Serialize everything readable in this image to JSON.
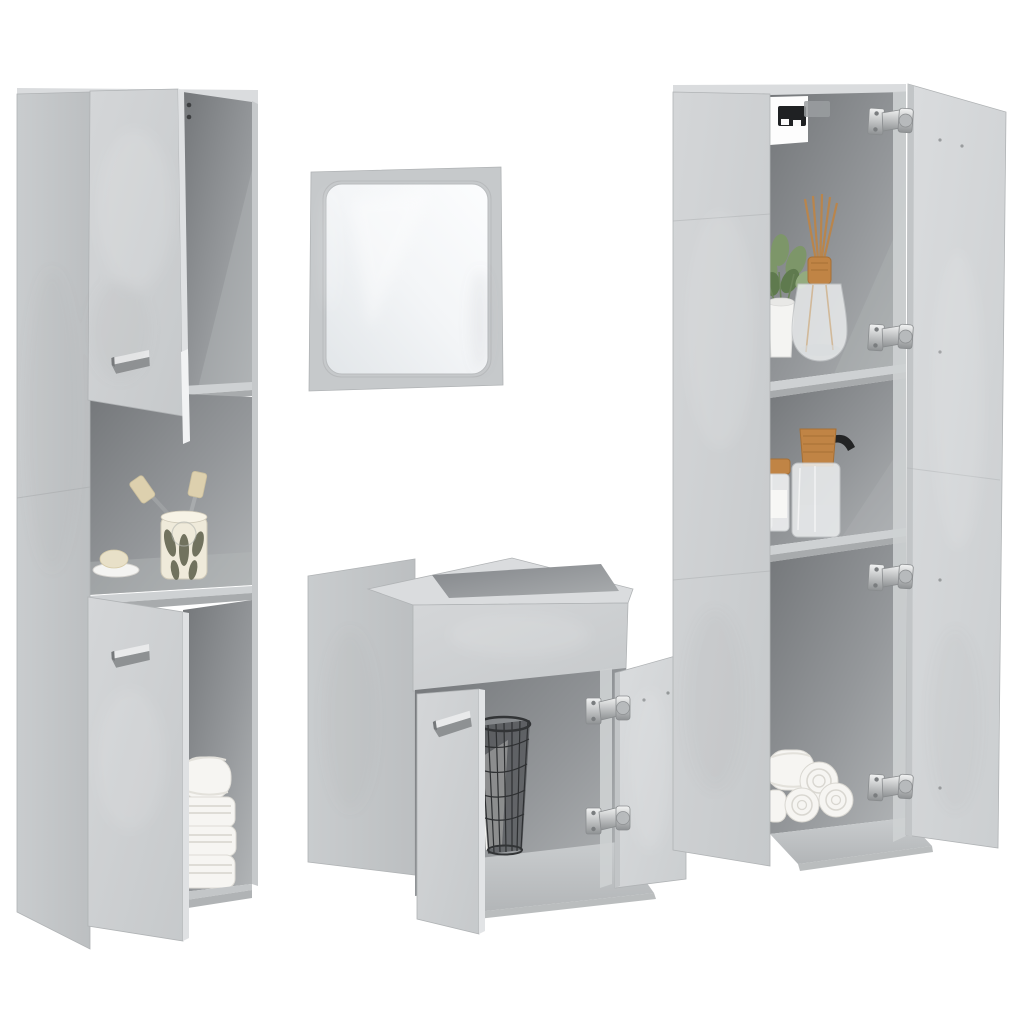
{
  "window": {
    "title": "Product photo: 4-piece bathroom furniture set, concrete grey",
    "background": "#ffffff"
  },
  "palette": {
    "background": "#ffffff",
    "cabinetFace": "#cfd2d4",
    "cabinetFaceBright": "#d8dadc",
    "cabinetSide": "#c3c6c8",
    "topSurface": "#dadcde",
    "interiorDark": "#74777a",
    "interiorMid": "#9b9ea1",
    "shelfFloor": "#ced1d3",
    "shelfEdge": "#a8abad",
    "edgeLine": "#9a9da0",
    "handleSilver": "#e9eaeb",
    "hingeSilver": "#c6c9cb",
    "towelWhite": "#f6f5f2",
    "towelShade": "#dedcd6",
    "basketWire": "#3b3d3f",
    "plantGreen": "#7d9669",
    "plantGreenDark": "#5f7a4e",
    "potWhite": "#f4f4f2",
    "reedTan": "#b9854c",
    "amber": "#c08445",
    "nozzleBlack": "#232425",
    "bracketBlack": "#1f2123",
    "mirrorFrame": "#c6c9cb",
    "mirrorGlassHi": "#fbfcfd",
    "mirrorGlassLo": "#dfe3e6",
    "ceramicCream": "#efeada",
    "leafOlive": "#5c5e49",
    "soapBeige": "#e8e0c8"
  },
  "scene": {
    "items": [
      {
        "id": "tall-cabinet-left",
        "label": "Tall concrete-grey bathroom cabinet, two closed doors, open niches with toothbrush cup, soap dish and folded white towels"
      },
      {
        "id": "wall-mirror",
        "label": "Square wall mirror with concrete-grey frame"
      },
      {
        "id": "sink-cabinet",
        "label": "Sink base cabinet, right door open showing wire basket with towel"
      },
      {
        "id": "tall-cabinet-right",
        "label": "Tall concrete-grey cabinet, door open showing plant, reed diffuser, soap dispenser, jar and rolled towels"
      }
    ]
  }
}
